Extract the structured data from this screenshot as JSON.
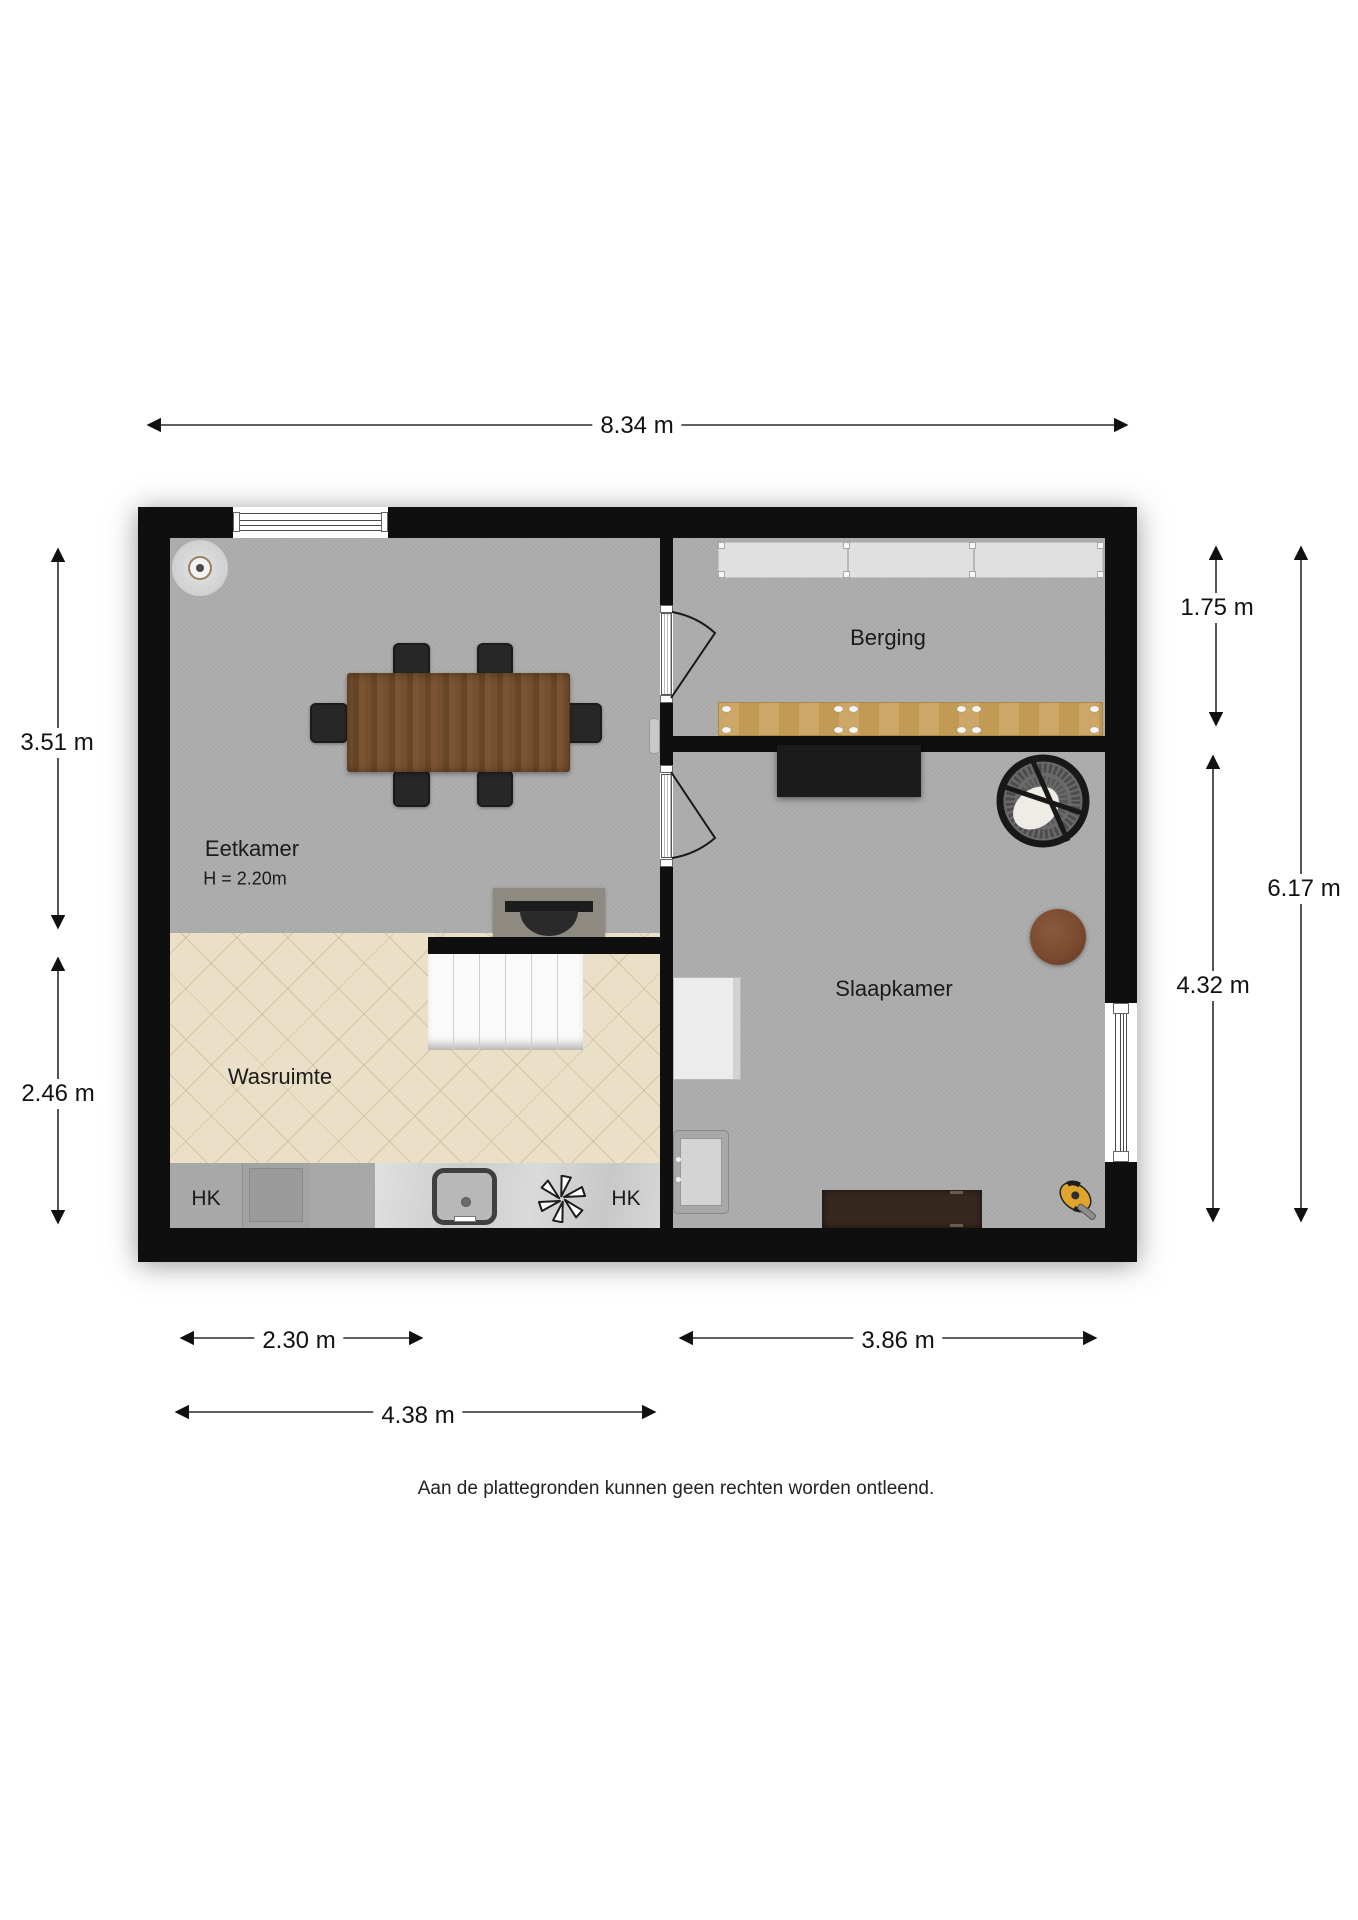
{
  "floorplan": {
    "rooms": {
      "eetkamer": {
        "label": "Eetkamer",
        "ceiling_height": "H = 2.20m"
      },
      "wasruimte": {
        "label": "Wasruimte"
      },
      "berging": {
        "label": "Berging"
      },
      "slaapkamer": {
        "label": "Slaapkamer"
      },
      "hk_left": "HK",
      "hk_right": "HK"
    },
    "dimensions": {
      "total_width_top": "8.34 m",
      "eetkamer_height_left": "3.51 m",
      "wasruimte_height_left": "2.46 m",
      "berging_depth_right": "1.75 m",
      "slaapkamer_depth_right": "4.32 m",
      "total_depth_right": "6.17 m",
      "wasruimte_width_bottom": "2.30 m",
      "slaapkamer_width_bottom": "3.86 m",
      "left_section_width_bottom": "4.38 m"
    },
    "disclaimer": "Aan de plattegronden kunnen geen rechten worden ontleend.",
    "colors": {
      "wall": "#0f0f0f",
      "floor_gray": "#adadad",
      "floor_wood_light": "#eadfc7",
      "counter_marble": "#d8d8d8",
      "shelf_gray": "#e0e0e0",
      "bench_wood": "#c9a263",
      "table_wood": "#6e4a2c",
      "furniture_black": "#1c1c1c",
      "dresser_brown": "#37281f",
      "side_table_brown": "#7b4b30",
      "toy_yellow": "#dfa42c"
    },
    "furniture_icons": [
      "ceiling-light-icon",
      "dining-table-icon",
      "dining-chair-icon",
      "radiator-icon",
      "storage-shelf-icon",
      "workbench-icon",
      "desk-icon",
      "hanging-chair-icon",
      "side-table-icon",
      "cabinet-icon",
      "wall-heater-icon",
      "dresser-icon",
      "toy-icon",
      "stairs-icon",
      "washbasin-icon",
      "kitchen-sink-icon",
      "extractor-fan-icon",
      "washing-machine-icon",
      "window-icon",
      "door-icon"
    ]
  }
}
